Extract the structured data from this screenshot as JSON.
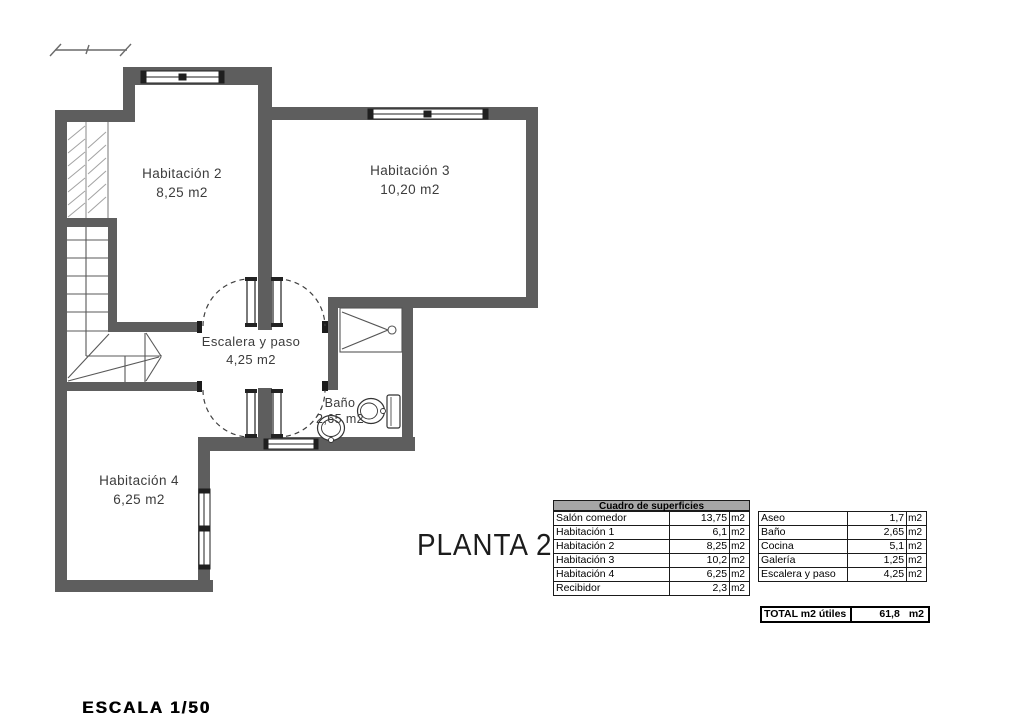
{
  "plan": {
    "title": "PLANTA 2",
    "scale_label": "ESCALA 1/50",
    "rooms": [
      {
        "name": "Habitación 2",
        "area": "8,25 m2"
      },
      {
        "name": "Habitación 3",
        "area": "10,20 m2"
      },
      {
        "name": "Habitación 4",
        "area": "6,25 m2"
      },
      {
        "name": "Escalera y paso",
        "area": "4,25 m2"
      },
      {
        "name": "Baño",
        "area": "2,65 m2"
      }
    ],
    "colors": {
      "wall": "#5e5e5e",
      "table_header_bg": "#a6a6a6",
      "line": "#555555"
    }
  },
  "table": {
    "title": "Cuadro de superficies",
    "left_rows": [
      {
        "name": "Salón comedor",
        "value": "13,75",
        "unit": "m2"
      },
      {
        "name": "Habitación 1",
        "value": "6,1",
        "unit": "m2"
      },
      {
        "name": "Habitación 2",
        "value": "8,25",
        "unit": "m2"
      },
      {
        "name": "Habitación 3",
        "value": "10,2",
        "unit": "m2"
      },
      {
        "name": "Habitación 4",
        "value": "6,25",
        "unit": "m2"
      },
      {
        "name": "Recibidor",
        "value": "2,3",
        "unit": "m2"
      }
    ],
    "right_rows": [
      {
        "name": "Aseo",
        "value": "1,7",
        "unit": "m2"
      },
      {
        "name": "Baño",
        "value": "2,65",
        "unit": "m2"
      },
      {
        "name": "Cocina",
        "value": "5,1",
        "unit": "m2"
      },
      {
        "name": "Galería",
        "value": "1,25",
        "unit": "m2"
      },
      {
        "name": "Escalera y paso",
        "value": "4,25",
        "unit": "m2"
      }
    ],
    "total": {
      "label": "TOTAL m2 útiles",
      "value": "61,8",
      "unit": "m2"
    }
  }
}
